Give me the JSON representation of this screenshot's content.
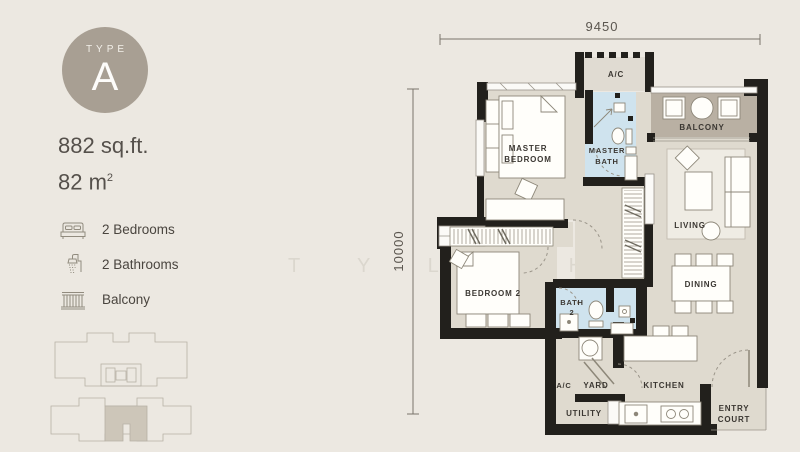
{
  "unit": {
    "type_label": "TYPE",
    "type_value": "A",
    "area_imperial": "882 sq.ft.",
    "area_metric_base": "82 m",
    "area_metric_sup": "2"
  },
  "legend": {
    "items": [
      {
        "icon": "bed-icon",
        "label": "2 Bedrooms"
      },
      {
        "icon": "shower-icon",
        "label": "2 Bathrooms"
      },
      {
        "icon": "balcony-icon",
        "label": "Balcony"
      }
    ]
  },
  "dimensions": {
    "top": "9450",
    "left": "10000"
  },
  "plan": {
    "labels": {
      "ac_top": "A/C",
      "master_bedroom_line1": "MASTER",
      "master_bedroom_line2": "BEDROOM",
      "master_bath_line1": "MASTER",
      "master_bath_line2": "BATH",
      "balcony": "BALCONY",
      "living": "LIVING",
      "dining": "DINING",
      "bedroom2": "BEDROOM 2",
      "bath2_line1": "BATH",
      "bath2_line2": "2",
      "ac_bottom": "A/C",
      "yard": "YARD",
      "kitchen": "KITCHEN",
      "utility": "UTILITY",
      "entry_line1": "ENTRY",
      "entry_line2": "COURT"
    }
  },
  "watermark": "T Y L O H",
  "colors": {
    "background": "#ece8e1",
    "badge": "#a89f93",
    "wall": "#22201c",
    "floor": "#dfdacf",
    "bath_floor": "#cfe3ee",
    "balcony_floor": "#b9b0a3",
    "text_dark": "#55504b",
    "furniture_line": "#8d8779"
  }
}
